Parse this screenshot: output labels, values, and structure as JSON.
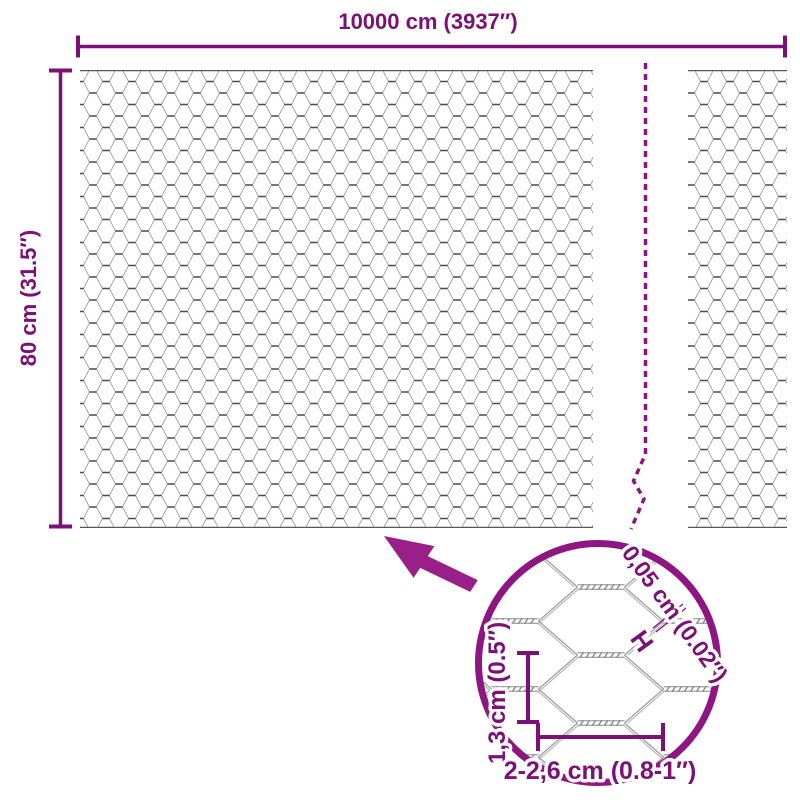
{
  "figure": {
    "labels": {
      "total_width": "10000 cm (3937″)",
      "total_height": "80 cm (31.5″)"
    },
    "detail": {
      "wire_diameter": "0,05 cm (0.02″)",
      "wire_marker": "H",
      "mesh_height": "1,3 cm (0.5″)",
      "mesh_width": "2-2,6 cm (0.8-1″)"
    },
    "colors": {
      "dimension": "#7d1077",
      "accent": "#8d1480",
      "arrow": "#9a2089",
      "circle": "#8e1682",
      "wire_dark": "#4a4a4a",
      "wire_light": "#8f8f8f",
      "background": "#ffffff"
    }
  }
}
